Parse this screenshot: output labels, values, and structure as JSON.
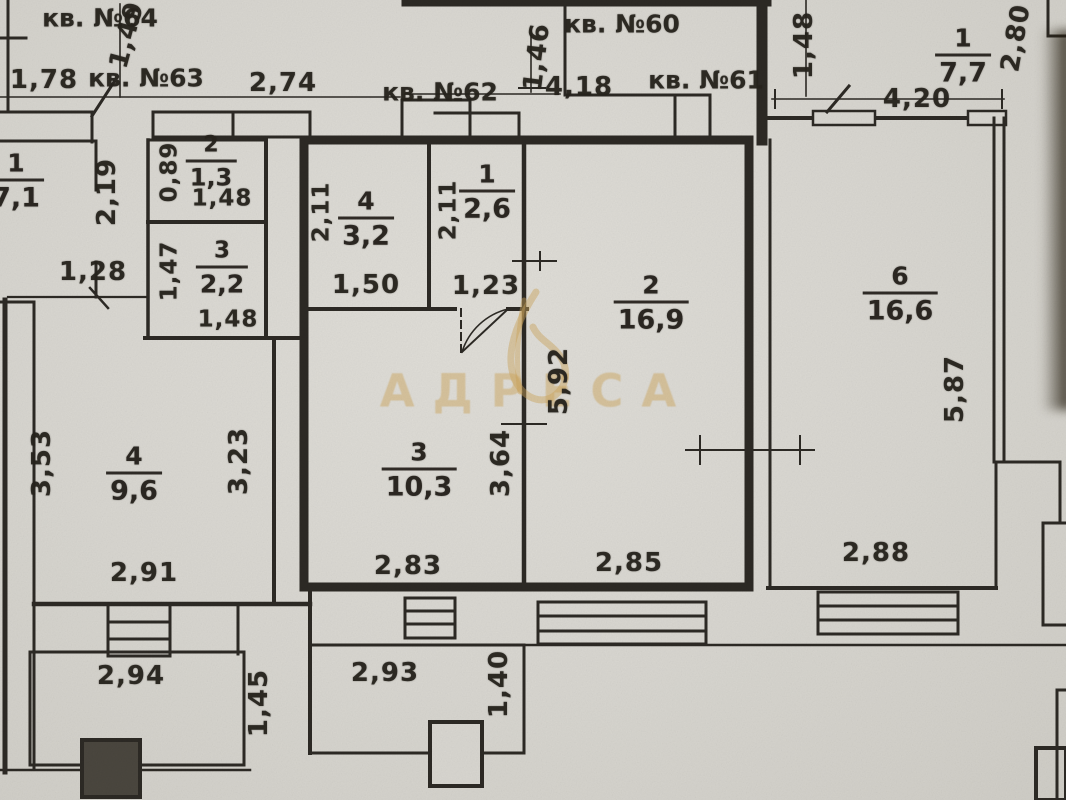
{
  "watermark": {
    "brand": "АДРЕСА"
  },
  "corridor": {
    "apt64": "кв. №64",
    "apt63": "кв. №63",
    "apt62": "кв. №62",
    "apt60": "кв. №60",
    "apt61": "кв. №61",
    "dims": {
      "d178": "1,78",
      "d149": "1,49",
      "d274": "2,74",
      "d146": "1,46",
      "d418": "4,18"
    }
  },
  "left_unit": {
    "room1": {
      "num": "1",
      "area": "7,1"
    },
    "room2": {
      "num": "2",
      "area": "1,3",
      "width": "1,48",
      "height": "0,89"
    },
    "room3": {
      "num": "3",
      "area": "2,2",
      "width": "1,48",
      "height": "1,47"
    },
    "room4": {
      "num": "4",
      "area": "9,6",
      "height_left": "3,53",
      "height_right": "3,23",
      "width": "2,91"
    },
    "dims": {
      "d219": "2,19",
      "d128": "1,28"
    }
  },
  "center_unit": {
    "room4": {
      "num": "4",
      "area": "3,2",
      "height": "2,11",
      "width": "1,50"
    },
    "room1": {
      "num": "1",
      "area": "2,6",
      "height": "2,11",
      "width": "1,23"
    },
    "room2": {
      "num": "2",
      "area": "16,9",
      "height": "5,92",
      "width": "2,85"
    },
    "room3": {
      "num": "3",
      "area": "10,3",
      "height": "3,64",
      "width": "2,83"
    }
  },
  "right_unit": {
    "room1": {
      "num": "1",
      "area": "7,7",
      "width": "4,20",
      "height": "2,80",
      "side": "1,48"
    },
    "room6": {
      "num": "6",
      "area": "16,6",
      "height": "5,87",
      "width": "2,88"
    }
  },
  "balconies": {
    "left": {
      "width": "2,94",
      "depth": "1,45"
    },
    "center": {
      "width": "2,93",
      "depth": "1,40"
    }
  },
  "colors": {
    "ink": "#2c2924",
    "paper": "#d8d6d0",
    "watermark": "#cda55c"
  }
}
